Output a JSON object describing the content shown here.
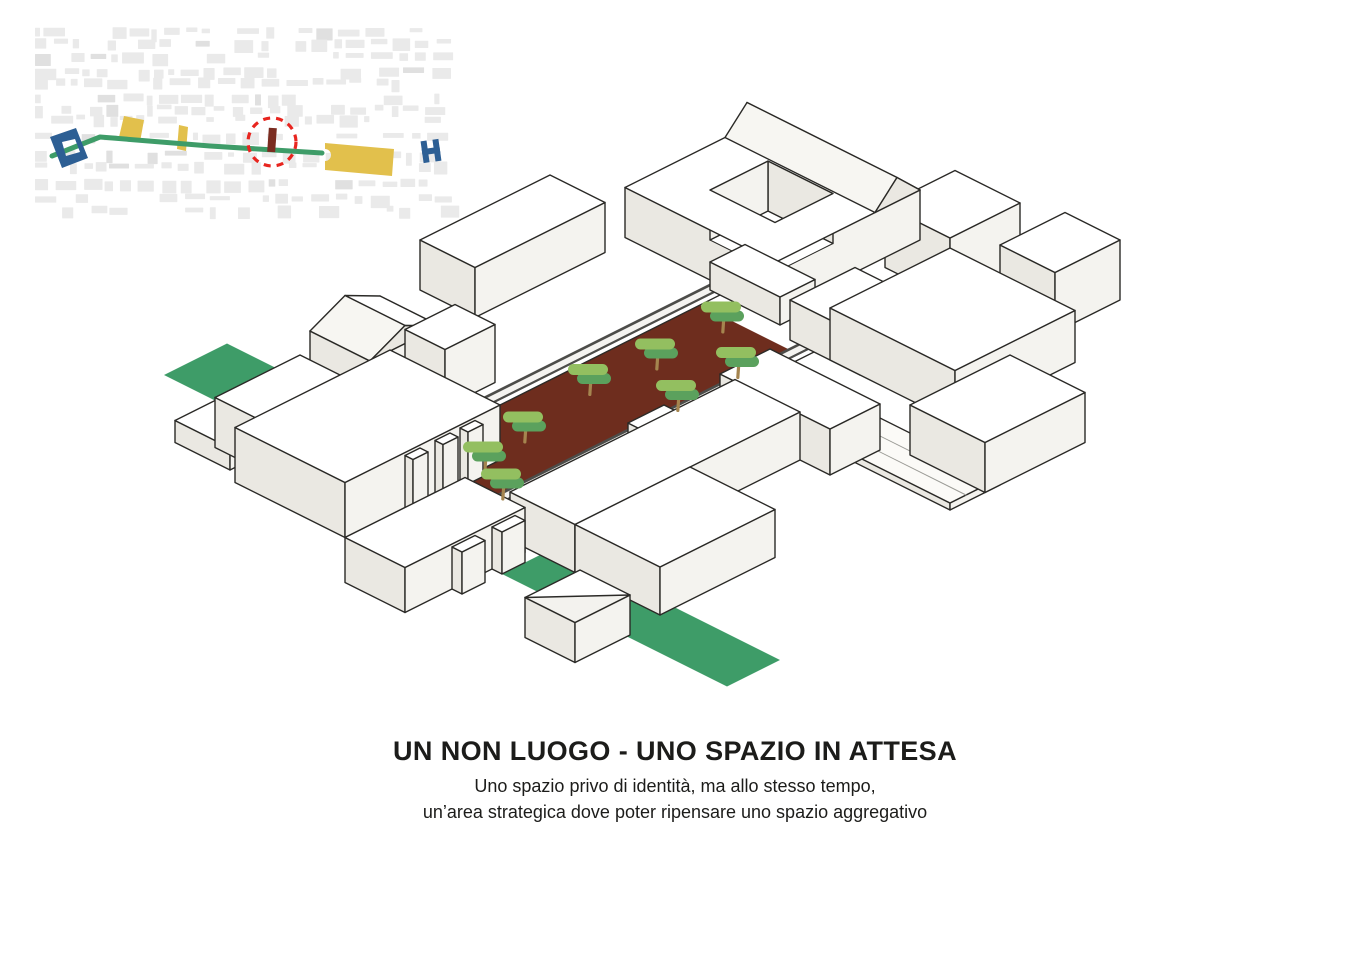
{
  "page": {
    "background_color": "#ffffff"
  },
  "caption": {
    "title": "UN NON LUOGO - UNO SPAZIO IN ATTESA",
    "subtitle_line1": "Uno spazio privo di identità, ma allo stesso tempo,",
    "subtitle_line2": "un’area strategica dove poter ripensare uno spazio aggregativo"
  },
  "locator_map": {
    "fabric_color": "#eaeaea",
    "fabric_dark_color": "#e0e0e0",
    "axis_color": "#3e9c68",
    "site_marker_color": "#7a2c20",
    "focus_ring_color": "#e8251f",
    "landmark_color": "#e2c04c",
    "endpoint_color": "#2d5f94"
  },
  "axonometric": {
    "outline_color": "#2b2a27",
    "building_top_color": "#ffffff",
    "building_face_light": "#f4f3ef",
    "building_face_shade": "#eae8e2",
    "roof_slope_color": "#f7f6f2",
    "plaza_color": "#6e2d1e",
    "green_color": "#3e9c68",
    "walkway_fill": "#f4f3f0",
    "walkway_edge_color": "#4d4d4a",
    "terrace_color": "#fbfaf7",
    "tree_canopy_light_color": "#93bf60",
    "tree_canopy_dark_color": "#5ba15d",
    "tree_trunk_color": "#a5854f",
    "tree_count": 8
  }
}
